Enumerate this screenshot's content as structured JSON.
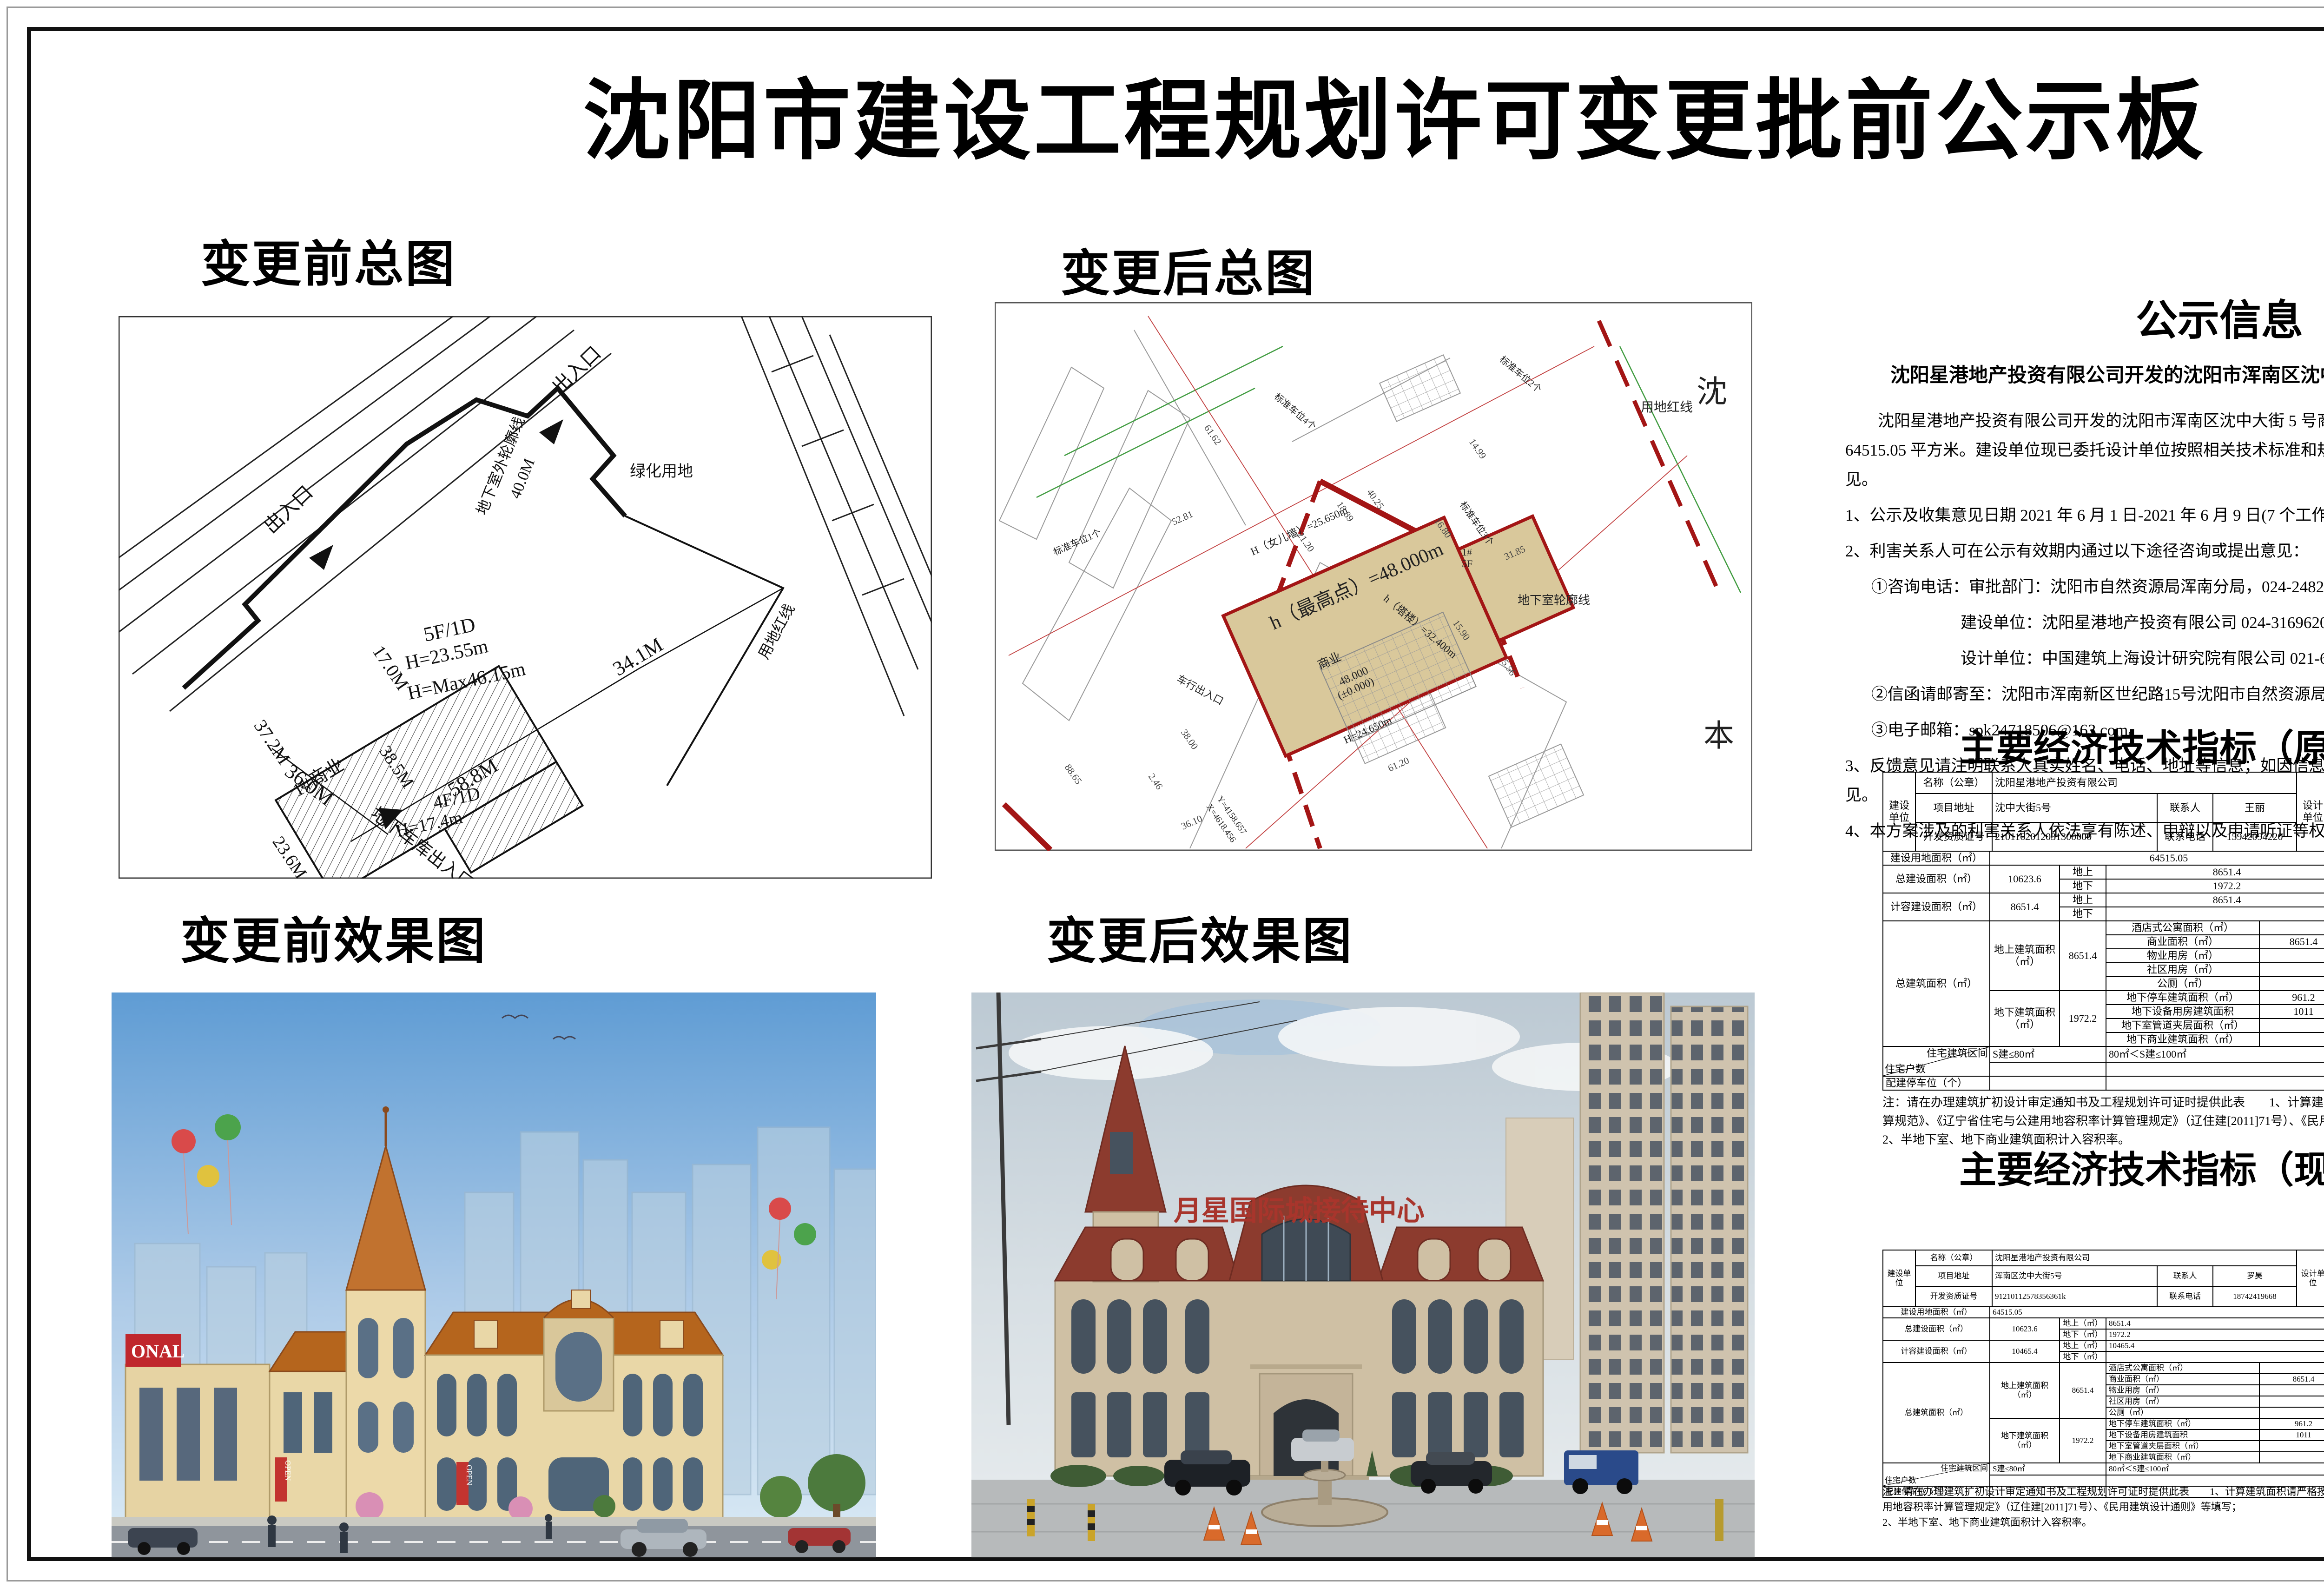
{
  "title": "沈阳市建设工程规划许可变更批前公示板",
  "sections": {
    "plan_before": "变更前总图",
    "plan_after": "变更后总图",
    "render_before": "变更前效果图",
    "render_after": "变更后效果图"
  },
  "notice": {
    "heading": "公示信息",
    "subtitle": "沈阳星港地产投资有限公司开发的沈阳市浑南区沈中大街5号商业一期-1项目规划变更批前公示",
    "paragraph": "沈阳星港地产投资有限公司开发的沈阳市浑南区沈中大街 5 号商业一期-1 项目，规划用地性质为商业用地，用地面积为 64515.05 平方米。建设单位现已委托设计单位按照相关技术标准和规范完成建设工程规划设计方案，现予以公示并公开征求意见。",
    "item1": "1、公示及收集意见日期 2021 年 6 月 1 日-2021 年 6 月 9 日(7 个工作日)；",
    "item2": "2、利害关系人可在公示有效期内通过以下途径咨询或提出意见：",
    "sub1": "①咨询电话：审批部门：沈阳市自然资源局浑南分局，024-24820955；",
    "sub2": "建设单位：沈阳星港地产投资有限公司 024-31696200；",
    "sub3": "设计单位：中国建筑上海设计研究院有限公司 021-62858180",
    "sub4": "②信函请邮寄至：沈阳市浑南新区世纪路15号沈阳市自然资源局浑南分局（以邮戳日期为准）邮编：100179",
    "sub5": "③电子邮箱：spk24718506@163.com。",
    "item3": "3、反馈意见请注明联系人真实姓名、电话、地址等信息；如因信息不完整或不真实导致无法核对相关情况的，视为无效意见。",
    "item4": "4、本方案涉及的利害关系人依法享有陈述、申辩以及申请听证等权利，逾期未申请则视为放弃上述权利。",
    "signature": "沈阳市自然资源局浑南分局",
    "date": "2021 年 6 月 1 日"
  },
  "L": {
    "jsdw": "建设单位",
    "sjdw": "设计单位",
    "mc": "名称（公章）",
    "xmdz": "项目地址",
    "lxr": "联系人",
    "kfzzh": "开发资质证号",
    "lxdh": "联系电话",
    "zzdj": "资质等级（建筑、规划）",
    "sjzzh": "设计资质证号",
    "jsydmj": "建设用地面积（㎡）",
    "symj": "商业面积（㎡）",
    "syb": "商业比（%）",
    "zjsmj": "总建设面积（㎡）",
    "ds": "地上",
    "dx": "地下",
    "dsm": "地上（㎡）",
    "dxm": "地下（㎡）",
    "jdmj": "基底面积（㎡）",
    "jzmd": "建筑密度（%）",
    "ldmj": "绿地面积（㎡）",
    "ldl": "绿地率（%）",
    "jrjsmj": "计容建设面积（㎡）",
    "rjl": "容积率",
    "dshu": "栋数",
    "tcw": "停车位（个）",
    "dsg": "地上（个）",
    "dxg": "地下（个）",
    "zjzmj": "总建筑面积（㎡）",
    "dsjzmj": "地上建筑面积（㎡）",
    "dxjzmj": "地下建筑面积（㎡）",
    "jdsgy": "酒店式公寓面积（㎡）",
    "wyyf": "物业用房（㎡）",
    "sqyf": "社区用房（㎡）",
    "gce": "公厕（㎡）",
    "dxtc": "地下停车建筑面积（㎡）",
    "dxsb": "地下设备用房建筑面积",
    "dxgd": "地下室管道夹层面积（㎡）",
    "dxsy": "地下商业建筑面积（㎡）",
    "beizhu": "备注",
    "zzhs": "住宅户数",
    "zzjzqj": "住宅建筑区间",
    "s80": "S建≤80㎡",
    "s100": "80㎡＜S建≤100㎡",
    "s150": "100㎡＜S建≤150㎡",
    "s150x": "S建＜150㎡",
    "pjtcw": "配建停车位（个）"
  },
  "t1": {
    "title": "主要经济技术指标（原指标）",
    "fill_date": "填表日期：2014年01月09日",
    "company": "沈阳星港地产投资有限公司",
    "addr": "沈中大街5号",
    "contact": "王丽",
    "cert": "2101162012031300000",
    "phone": "15942094220",
    "design": "中国建筑上海设计研究院有限公司",
    "grade": "甲级",
    "dcontact": "邓世雄",
    "dcert": "A131002449",
    "dphone": "15618988488",
    "land": "64515.05",
    "sy": "8651.4",
    "syb": "",
    "zong": "10623.6",
    "zds": "8651.4",
    "zdx": "1972.2",
    "jd": "1988.8",
    "md": "3%",
    "lv": "1509.16",
    "lvl": "20%",
    "jr": "8651.4",
    "jrds": "8651.4",
    "jrdx": "",
    "rjl": "0.13",
    "dong": "1",
    "tcw": "42",
    "tds": "22",
    "tdx": "20",
    "dsmj": "8651.4",
    "sy2": "8651.4",
    "dxmj": "1972.2",
    "tc": "961.2",
    "sb": "1011",
    "remark": "",
    "qt": "其它（商业建筑面积",
    "qtmj": "8651.4",
    "qttcw": "42",
    "note1": "注：请在办理建筑扩初设计审定通知书及工程规划许可证时提供此表　　1、计算建筑面积请严格按照《住宅设计规范》、《住宅建筑规范》、《建筑工程建筑面积计算规范》、《辽宁省住宅与公建用地容积率计算管理规定》（辽住建[2011]71号）、《民用建筑设计通则》等填写；",
    "note2": "2、半地下室、地下商业建筑面积计入容积率。"
  },
  "t2": {
    "title": "主要经济技术指标（现指标）",
    "fill_date": "填表日期：  2021 年 04 月 23 日",
    "company": "沈阳星港地产投资有限公司",
    "addr": "浑南区沈中大街5号",
    "contact": "罗昊",
    "cert": "91210112578356361k",
    "phone": "18742419668",
    "design": "中国建筑上海设计研究院有限公司",
    "grade": "建筑甲级",
    "dcontact": "朱元东",
    "dcert": "甲级工程设计证书A131002449",
    "dphone": "13681904900",
    "land": "64515.05",
    "sy": "8651.4",
    "syb": "100%",
    "zong": "10623.6",
    "zds": "8651.4",
    "zdx": "1972.2",
    "jd": "1988.8",
    "md": "3%",
    "lv": "1509.16",
    "lvl": "20%",
    "jr": "10465.4",
    "jrds": "10465.4",
    "jrdx": "",
    "rjl": "0.16",
    "dong": "1",
    "tcw": "42",
    "tds": "22",
    "tdx": "20",
    "dsmj": "8651.4",
    "sy2": "8651.4",
    "dxmj": "1972.2",
    "tc": "961.2",
    "sb": "1011",
    "remark": "层高大于4.8米且小于等于6.0米的商业建筑面积，地上1983.59平方米，层高大于7.8米的商业建筑面积，地上411.1平方米；",
    "qt": "其它（商业建筑面积等）",
    "qtmj": "8651.4",
    "qttcw": "42",
    "note1": "注：请在办理建筑扩初设计审定通知书及工程规划许可证时提供此表　　1、计算建筑面积请严格按照《住宅设计规范》、《住宅建筑规范》、《建筑工程建筑面积计算规范》、《辽宁省住宅与公建用地容积率计算管理规定》（辽住建[2011]71号）、《民用建筑设计通则》等填写；",
    "note2": "2、半地下室、地下商业建筑面积计入容积率。"
  },
  "plan_before": {
    "entrance1": "出入口",
    "entrance2": "出入口",
    "green": "绿化用地",
    "d17": "17.0M",
    "d372": "37.2M",
    "bld": "1#商业",
    "f5": "5F/1D",
    "h2355": "H=23.55m",
    "hmax": "H=Max46.15m",
    "d385": "38.5M",
    "f4": "4F/1D",
    "h174": "H=17.4m",
    "d588": "58.8M",
    "d341": "34.1M",
    "d236": "23.6M",
    "d360": "36.0M",
    "garage": "地下车库出入口",
    "redline": "用地红线",
    "basement": "地下室外轮廓线",
    "d400": "40.0M"
  },
  "plan_after": {
    "shen": "沈",
    "ben": "本",
    "hmax": "h（最高点）=48.000m",
    "sy": "商业",
    "lvl": "48.000",
    "lvl2": "(±0.000)",
    "parapet": "H（女儿墙）=25.650m",
    "tower": "h（塔楼）=32.400m",
    "b1": "1#",
    "f5": "5F",
    "h2465": "H=24.650m",
    "basement": "地下室轮廓线",
    "redline": "用地红线",
    "entry": "车行出入口",
    "p1": "标准车位1个",
    "p2": "标准车位2个",
    "p3": "标准车位3个",
    "p4": "标准车位4个",
    "cx": "X=4618.456",
    "cy": "Y=4158.657",
    "d5281": "52.81",
    "d6162": "61.62",
    "d1499": "14.99",
    "d1680": "16.80",
    "d3185": "31.85",
    "d2120": "21.20",
    "d1590": "15.90",
    "d556": "5.56",
    "d6120": "61.20",
    "d3800": "38.00",
    "d3610": "36.10",
    "d246": "2.46",
    "d8865": "88.65",
    "d1889": "18.89",
    "d4025": "40.25"
  },
  "render_before": {
    "sign_partial": "ONAL",
    "banner": "OPEN"
  },
  "render_after": {
    "sign": "月星国际城接待中心"
  }
}
